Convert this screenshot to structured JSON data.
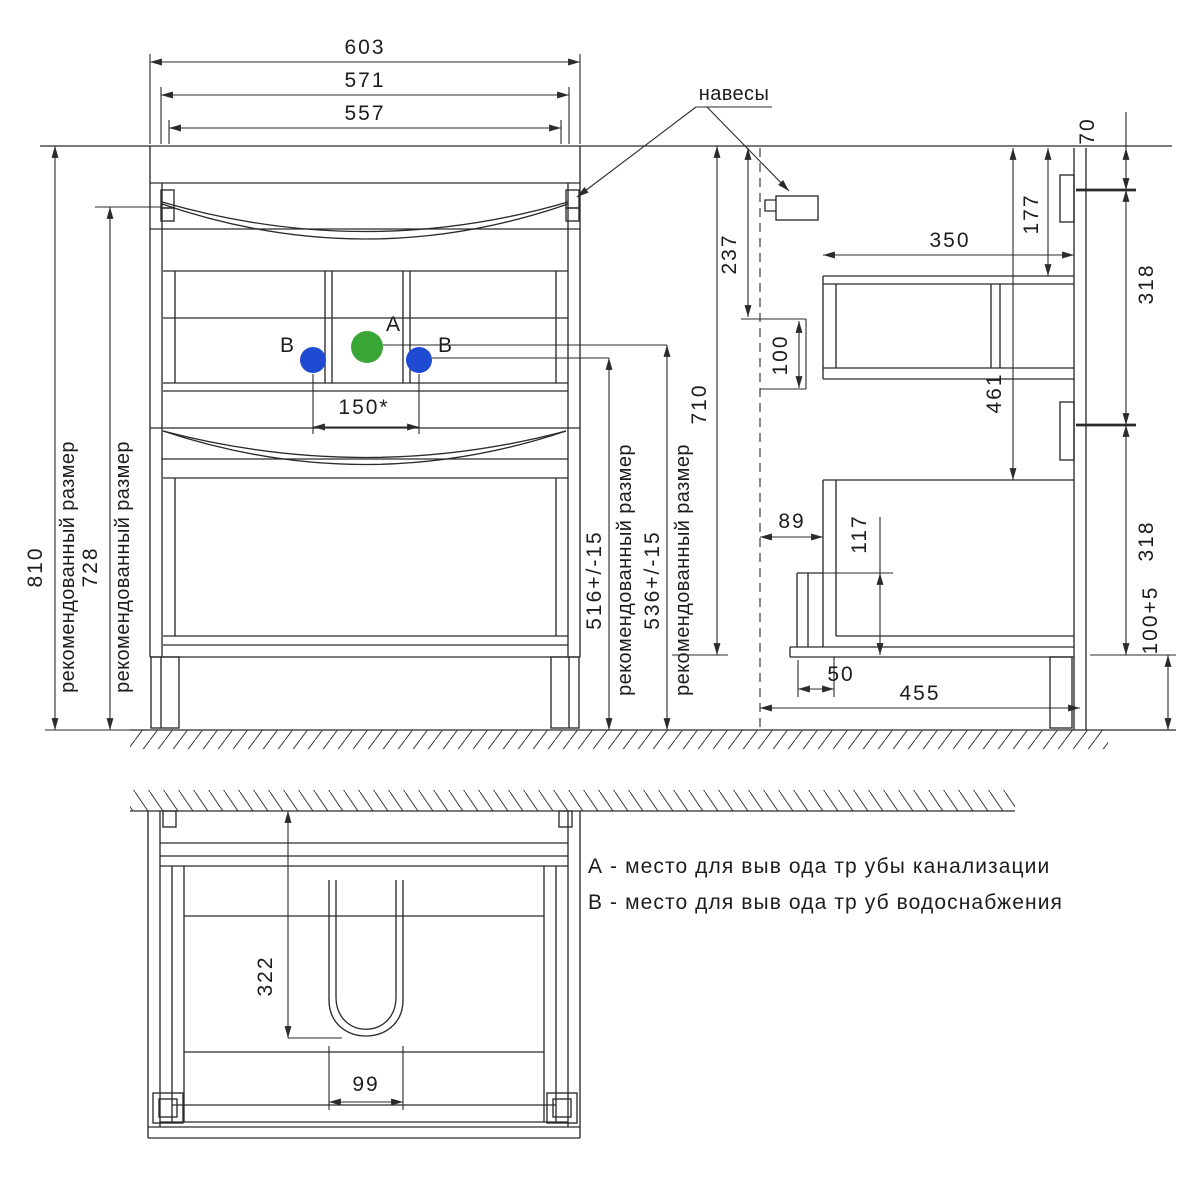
{
  "front": {
    "width_total": "603",
    "width_body": "571",
    "width_inner": "557",
    "height_recommended": "810",
    "height_mount": "728",
    "rec_size": "рекомендованный размер",
    "pipe_spacing": "150*",
    "water_height": "516+/-15",
    "drain_height": "536+/-15",
    "cabinet_height": "710",
    "label_a": "A",
    "label_b": "B"
  },
  "side": {
    "callout_hangers": "навесы",
    "top_offset": "70",
    "bracket_drop": "237",
    "pipe_zone": "100",
    "upper_front_height": "177",
    "upper_depth": "350",
    "upper_section": "318",
    "lower_top": "461",
    "lower_section": "318",
    "front_clearance": "89",
    "toe_height": "117",
    "leg_setback": "50",
    "depth_total": "455",
    "leg_height": "100+5"
  },
  "plan": {
    "cutout_depth": "322",
    "cutout_width": "99"
  },
  "legend": {
    "line_a": "А - место для выв ода тр убы канализации",
    "line_b": "В - место для выв ода тр уб водоснабжения"
  },
  "colors": {
    "drain_a": "#3aa636",
    "water_b": "#1e4bd2"
  }
}
